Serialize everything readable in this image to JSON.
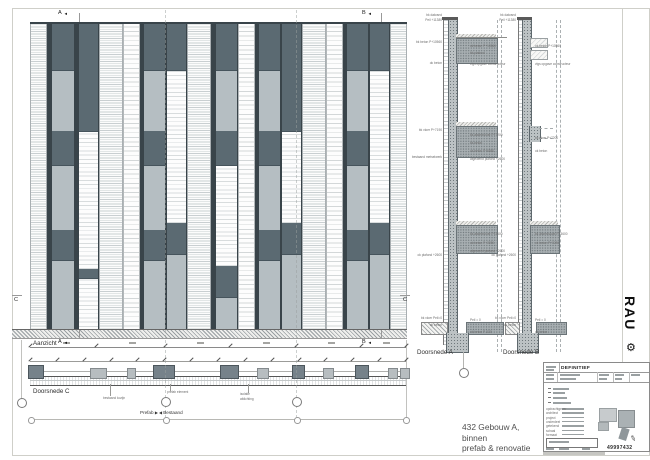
{
  "sheet": {
    "drawing_title": [
      "432 Gebouw A,",
      "binnen",
      "prefab & renovatie"
    ],
    "logo": {
      "text": "RAU",
      "gear_icon": "⚙"
    },
    "labels": {
      "aanzicht": "Aanzicht",
      "doorsnede_a": "Doorsnede A",
      "doorsnede_b": "Doorsnede B",
      "doorsnede_c": "Doorsnede C",
      "prefab": "Prefab",
      "bestaand": "Bestaand"
    },
    "section_markers": {
      "a": "A",
      "b": "B",
      "c": "C"
    },
    "colors": {
      "panel_dark": "#5b6a72",
      "panel_light": "#b5bec2",
      "frame_dark": "#39444a",
      "slab_gray": "#a8afb2",
      "hatch_gray": "#9aa0a3",
      "title_text": "#4f4f4f"
    }
  },
  "facade": {
    "strips": [
      {
        "w": 13,
        "t": "louver"
      },
      {
        "w": 3,
        "t": "frame"
      },
      {
        "w": 19,
        "t": "panel",
        "s": [
          [
            "d",
            15
          ],
          [
            "l",
            20
          ],
          [
            "d",
            11
          ],
          [
            "l",
            21
          ],
          [
            "d",
            10
          ],
          [
            "l",
            23
          ]
        ]
      },
      {
        "w": 3,
        "t": "frame"
      },
      {
        "w": 16,
        "t": "panel",
        "s": [
          [
            "d",
            35
          ],
          [
            "w",
            45
          ],
          [
            "d",
            3
          ],
          [
            "w",
            17
          ]
        ]
      },
      {
        "w": 19,
        "t": "louver"
      },
      {
        "w": 13,
        "t": "sparse"
      },
      {
        "w": 3,
        "t": "frame"
      },
      {
        "w": 18,
        "t": "panel",
        "s": [
          [
            "d",
            15
          ],
          [
            "l",
            20
          ],
          [
            "d",
            11
          ],
          [
            "l",
            21
          ],
          [
            "d",
            10
          ],
          [
            "l",
            23
          ]
        ]
      },
      {
        "w": 16,
        "t": "panel",
        "s": [
          [
            "d",
            15
          ],
          [
            "w",
            50
          ],
          [
            "d",
            10
          ],
          [
            "l",
            25
          ]
        ]
      },
      {
        "w": 19,
        "t": "louver"
      },
      {
        "w": 3,
        "t": "frame"
      },
      {
        "w": 18,
        "t": "panel",
        "s": [
          [
            "d",
            15
          ],
          [
            "l",
            20
          ],
          [
            "d",
            11
          ],
          [
            "w",
            33
          ],
          [
            "d",
            10
          ],
          [
            "l",
            11
          ]
        ]
      },
      {
        "w": 13,
        "t": "sparse"
      },
      {
        "w": 3,
        "t": "frame"
      },
      {
        "w": 18,
        "t": "panel",
        "s": [
          [
            "d",
            15
          ],
          [
            "l",
            20
          ],
          [
            "d",
            11
          ],
          [
            "l",
            21
          ],
          [
            "d",
            10
          ],
          [
            "l",
            23
          ]
        ]
      },
      {
        "w": 16,
        "t": "panel",
        "s": [
          [
            "d",
            35
          ],
          [
            "w",
            30
          ],
          [
            "d",
            10
          ],
          [
            "l",
            25
          ]
        ]
      },
      {
        "w": 19,
        "t": "louver"
      },
      {
        "w": 13,
        "t": "sparse"
      },
      {
        "w": 3,
        "t": "frame"
      },
      {
        "w": 18,
        "t": "panel",
        "s": [
          [
            "d",
            15
          ],
          [
            "l",
            20
          ],
          [
            "d",
            11
          ],
          [
            "l",
            21
          ],
          [
            "d",
            10
          ],
          [
            "l",
            23
          ]
        ]
      },
      {
        "w": 16,
        "t": "panel",
        "s": [
          [
            "d",
            15
          ],
          [
            "w",
            50
          ],
          [
            "d",
            10
          ],
          [
            "l",
            25
          ]
        ]
      },
      {
        "w": 13,
        "t": "louver"
      }
    ]
  },
  "doorsnede_c": {
    "blocks": [
      {
        "x": 28,
        "w": 14,
        "dark": true
      },
      {
        "x": 90,
        "w": 15,
        "dark": false
      },
      {
        "x": 127,
        "w": 7,
        "dark": false
      },
      {
        "x": 153,
        "w": 20,
        "dark": true
      },
      {
        "x": 220,
        "w": 17,
        "dark": true
      },
      {
        "x": 257,
        "w": 10,
        "dark": false
      },
      {
        "x": 292,
        "w": 11,
        "dark": true
      },
      {
        "x": 323,
        "w": 9,
        "dark": false
      },
      {
        "x": 355,
        "w": 12,
        "dark": true
      },
      {
        "x": 388,
        "w": 8,
        "dark": false
      },
      {
        "x": 400,
        "w": 8,
        "dark": false
      }
    ],
    "notes": [
      {
        "x": 103,
        "y": 396,
        "text": "bestaand kozijn"
      },
      {
        "x": 167,
        "y": 390,
        "text": "prefab element"
      },
      {
        "x": 240,
        "y": 392,
        "text": "isolatie"
      },
      {
        "x": 240,
        "y": 397,
        "text": "afdichting"
      }
    ]
  },
  "sections": {
    "a": {
      "left_notes": [
        {
          "y": 13,
          "text": "bk dakrand"
        },
        {
          "y": 18,
          "text": "Peil +11380"
        },
        {
          "y": 40,
          "text": "bk beton P+10560"
        },
        {
          "y": 61,
          "text": "ok beton"
        },
        {
          "y": 128,
          "text": "bk vloer P+7190"
        },
        {
          "y": 155,
          "text": "bestaand metselwerk"
        },
        {
          "y": 253,
          "text": "ok plafond +2600"
        },
        {
          "y": 316,
          "text": "bk vloer Peil=0"
        },
        {
          "y": 323,
          "text": "ok beton"
        }
      ],
      "right_notes": [
        {
          "y": 44,
          "text": "ok beton P+10560"
        },
        {
          "y": 51,
          "text": "bk plafond"
        },
        {
          "y": 62,
          "text": "vlgs opgave constructeur"
        },
        {
          "y": 133,
          "text": "bk afwerkvloer P+7200"
        },
        {
          "y": 141,
          "text": "bk beton"
        },
        {
          "y": 149,
          "text": "ok beton P+6880"
        },
        {
          "y": 157,
          "text": "afgewerkt plafond +2600"
        },
        {
          "y": 232,
          "text": "bk afwerkvloer P+3600"
        },
        {
          "y": 241,
          "text": "ok beton P+3280"
        },
        {
          "y": 249,
          "text": "afgewerkt plafond +2600"
        },
        {
          "y": 318,
          "text": "Peil = 0"
        },
        {
          "y": 330,
          "text": "ok beton P-330"
        }
      ]
    },
    "b": {
      "left_notes": [
        {
          "y": 13,
          "text": "bk dakrand"
        },
        {
          "y": 18,
          "text": "Peil +11380"
        },
        {
          "y": 253,
          "text": "ok plafond +2600"
        },
        {
          "y": 316,
          "text": "bk vloer Peil=0"
        },
        {
          "y": 323,
          "text": "ok beton"
        }
      ],
      "right_notes": [
        {
          "y": 44,
          "text": "ok beton P+10560"
        },
        {
          "y": 62,
          "text": "vlgs opgave constructeur"
        },
        {
          "y": 136,
          "text": "bk vloer P+7200"
        },
        {
          "y": 149,
          "text": "ok beton"
        },
        {
          "y": 232,
          "text": "bk afwerkvloer P+3600"
        },
        {
          "y": 241,
          "text": "ok beton P+3280"
        },
        {
          "y": 318,
          "text": "Peil = 0"
        },
        {
          "y": 330,
          "text": "ok beton"
        }
      ]
    }
  },
  "titleblock": {
    "status": "DEFINITIEF",
    "doc_number": "49997432",
    "pencil_icon": "✎",
    "field_labels": [
      "opdrachtgever",
      "architect",
      "project",
      "onderdeel",
      "getekend",
      "schaal",
      "formaat"
    ]
  }
}
